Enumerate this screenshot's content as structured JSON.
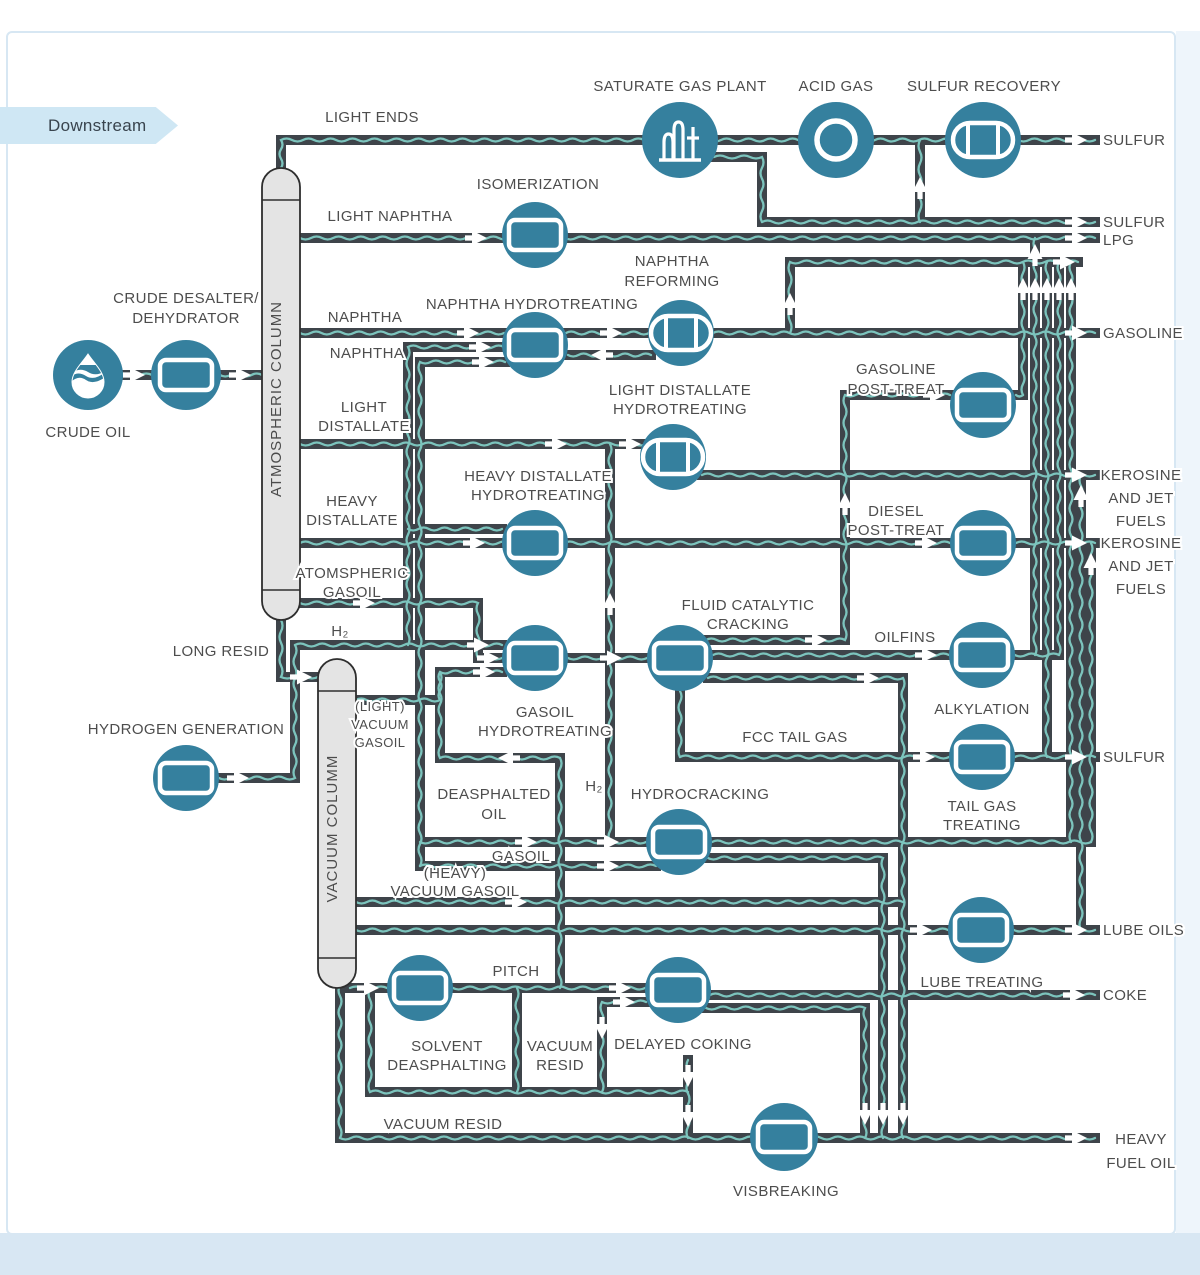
{
  "banner": {
    "label": "Downstream"
  },
  "colors": {
    "pipe": "#3e444a",
    "wave": "#7cc4bd",
    "unit": "#35809e",
    "icon": "#ffffff",
    "column_fill": "#e4e4e4",
    "column_stroke": "#2e2e2e",
    "label_text": "#4d4d4d",
    "banner_bg": "#cfe7f4",
    "frame": "#d7e7f3"
  },
  "columns": [
    {
      "id": "atmospheric-column",
      "label": "ATMOSPHERIC COLUMN"
    },
    {
      "id": "vacuum-column",
      "label": "VACUUM COLUMM"
    }
  ],
  "nodes": [
    {
      "id": "crude-oil",
      "label": "CRUDE OIL",
      "icon": "droplet"
    },
    {
      "id": "crude-desalter",
      "label_lines": [
        "CRUDE DESALTER/",
        "DEHYDRATOR"
      ],
      "icon": "vessel"
    },
    {
      "id": "saturate-gas-plant",
      "label": "SATURATE GAS PLANT",
      "icon": "plant"
    },
    {
      "id": "acid-gas",
      "label": "ACID GAS",
      "icon": "ring"
    },
    {
      "id": "sulfur-recovery",
      "label": "SULFUR RECOVERY",
      "icon": "drum"
    },
    {
      "id": "isomerization",
      "label": "ISOMERIZATION",
      "icon": "vessel"
    },
    {
      "id": "naphtha-hydrotreating",
      "label": "NAPHTHA HYDROTREATING",
      "icon": "vessel"
    },
    {
      "id": "naphtha-reforming",
      "label_lines": [
        "NAPHTHA",
        "REFORMING"
      ],
      "icon": "drum"
    },
    {
      "id": "light-distallate-hydrotreating",
      "label_lines": [
        "LIGHT DISTALLATE",
        "HYDROTREATING"
      ],
      "icon": "drum"
    },
    {
      "id": "heavy-distallate-hydrotreating",
      "label_lines": [
        "HEAVY DISTALLATE",
        "HYDROTREATING"
      ],
      "icon": "vessel"
    },
    {
      "id": "gasoline-post-treat",
      "label_lines": [
        "GASOLINE",
        "POST-TREAT"
      ],
      "icon": "vessel"
    },
    {
      "id": "diesel-post-treat",
      "label_lines": [
        "DIESEL",
        "POST-TREAT"
      ],
      "icon": "vessel"
    },
    {
      "id": "fluid-catalytic-cracking",
      "label_lines": [
        "FLUID CATALYTIC",
        "CRACKING"
      ],
      "icon": "vessel"
    },
    {
      "id": "alkylation",
      "label": "ALKYLATION",
      "icon": "vessel"
    },
    {
      "id": "tail-gas-treating",
      "label_lines": [
        "TAIL GAS",
        "TREATING"
      ],
      "icon": "vessel"
    },
    {
      "id": "gasoil-hydrotreating",
      "label_lines": [
        "GASOIL",
        "HYDROTREATING"
      ],
      "icon": "vessel"
    },
    {
      "id": "hydrocracking",
      "label": "HYDROCRACKING",
      "icon": "vessel"
    },
    {
      "id": "hydrogen-generation",
      "label": "HYDROGEN GENERATION",
      "icon": "vessel"
    },
    {
      "id": "solvent-deasphalting",
      "label_lines": [
        "SOLVENT",
        "DEASPHALTING"
      ],
      "icon": "vessel"
    },
    {
      "id": "delayed-coking",
      "label": "DELAYED COKING",
      "icon": "vessel"
    },
    {
      "id": "lube-treating",
      "label": "LUBE TREATING",
      "icon": "vessel"
    },
    {
      "id": "visbreaking",
      "label": "VISBREAKING",
      "icon": "vessel"
    }
  ],
  "streams": [
    {
      "id": "light-ends",
      "text": "LIGHT ENDS"
    },
    {
      "id": "light-naphtha",
      "text": "LIGHT NAPHTHA"
    },
    {
      "id": "naphtha-1",
      "text": "NAPHTHA"
    },
    {
      "id": "naphtha-2",
      "text": "NAPHTHA"
    },
    {
      "id": "light-distallate",
      "lines": [
        "LIGHT",
        "DISTALLATE"
      ]
    },
    {
      "id": "heavy-distallate",
      "lines": [
        "HEAVY",
        "DISTALLATE"
      ]
    },
    {
      "id": "atomspheric-gasoil",
      "lines": [
        "ATOMSPHERIC",
        "GASOIL"
      ]
    },
    {
      "id": "h2-1",
      "text": "H₂"
    },
    {
      "id": "long-resid",
      "text": "LONG RESID"
    },
    {
      "id": "light-vacuum-gasoil",
      "lines": [
        "(LIGHT)",
        "VACUUM",
        "GASOIL"
      ]
    },
    {
      "id": "deasphalted-oil",
      "lines": [
        "DEASPHALTED",
        "OIL"
      ]
    },
    {
      "id": "h2-2",
      "text": "H₂"
    },
    {
      "id": "gasoil",
      "text": "GASOIL"
    },
    {
      "id": "heavy-vacuum-gasoil",
      "lines": [
        "(HEAVY)",
        "VACUUM GASOIL"
      ]
    },
    {
      "id": "fcc-tail-gas",
      "text": "FCC TAIL GAS"
    },
    {
      "id": "pitch",
      "text": "PITCH"
    },
    {
      "id": "vacuum-resid-box",
      "lines": [
        "VACUUM",
        "RESID"
      ]
    },
    {
      "id": "vacuum-resid",
      "text": "VACUUM RESID"
    },
    {
      "id": "oilfins",
      "text": "OILFINS"
    }
  ],
  "outputs": [
    {
      "id": "sulfur-1",
      "text": "SULFUR"
    },
    {
      "id": "sulfur-2",
      "text": "SULFUR"
    },
    {
      "id": "lpg",
      "text": "LPG"
    },
    {
      "id": "gasoline",
      "text": "GASOLINE"
    },
    {
      "id": "kerosine-jet-1",
      "lines": [
        "KEROSINE",
        "AND JET",
        "FUELS"
      ]
    },
    {
      "id": "kerosine-jet-2",
      "lines": [
        "KEROSINE",
        "AND JET",
        "FUELS"
      ]
    },
    {
      "id": "sulfur-3",
      "text": "SULFUR"
    },
    {
      "id": "lube-oils",
      "text": "LUBE OILS"
    },
    {
      "id": "coke",
      "text": "COKE"
    },
    {
      "id": "heavy-fuel-oil",
      "lines": [
        "HEAVY",
        "FUEL OIL"
      ]
    }
  ]
}
